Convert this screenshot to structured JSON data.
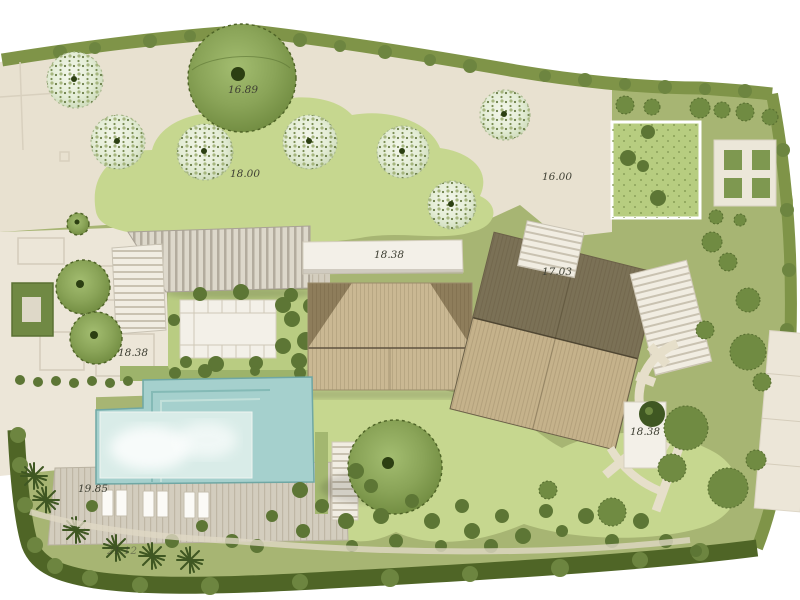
{
  "plan": {
    "elevations": {
      "big_tree": "16.89",
      "upper_lawn": "18.00",
      "gravel_court": "16.00",
      "north_terrace": "18.38",
      "stair_landing": "17.03",
      "west_court": "18.38",
      "east_terrace": "18.38",
      "pool_deck": "19.85",
      "south_path": "21.12"
    },
    "colors": {
      "paper": "#ffffff",
      "ground": "#a7b573",
      "paving": "#e8e1d0",
      "paving_light": "#ece6d8",
      "lawn": "#c6d78f",
      "lawn_square": "#b7cd80",
      "hedge": "#7f9448",
      "hedge_dark": "#4f6526",
      "hedge_bump": "#6d8540",
      "shrub": "#5d7635",
      "canopy_dark": "#2c3f12",
      "white_terrace": "#f3f0e8",
      "roof_tan": "#cab893",
      "roof_dark": "#8e7d5b",
      "roof2_dark": "#7b7156",
      "roof2_tan": "#c5b28b",
      "pool_deep": "#a5d0cd",
      "pool_shallow": "#d9ece8",
      "deck": "#d3cdbe",
      "label": "#3f4034"
    }
  }
}
